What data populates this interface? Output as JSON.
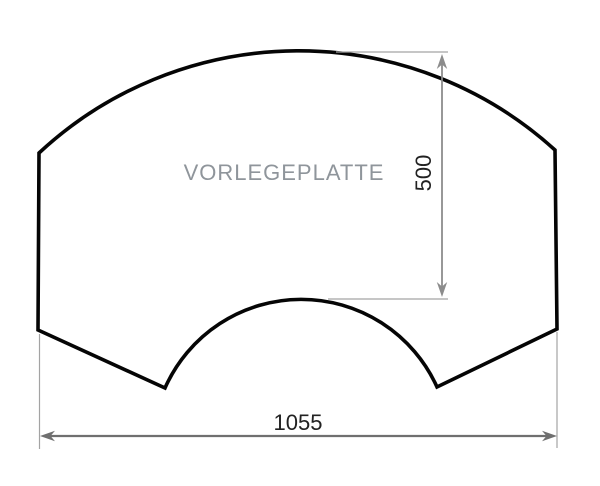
{
  "drawing": {
    "part_label": "VORLEGEPLATTE",
    "height_dimension": {
      "value": "500"
    },
    "width_dimension": {
      "value": "1055"
    },
    "colors": {
      "outline": "#050505",
      "height_dimension_line": "#8c8c8c",
      "width_dimension_line": "#6f6f6f",
      "extension_line": "#a3a3a3",
      "dimension_text": "#222222",
      "label_text": "#8f959b",
      "background": "#ffffff"
    }
  }
}
